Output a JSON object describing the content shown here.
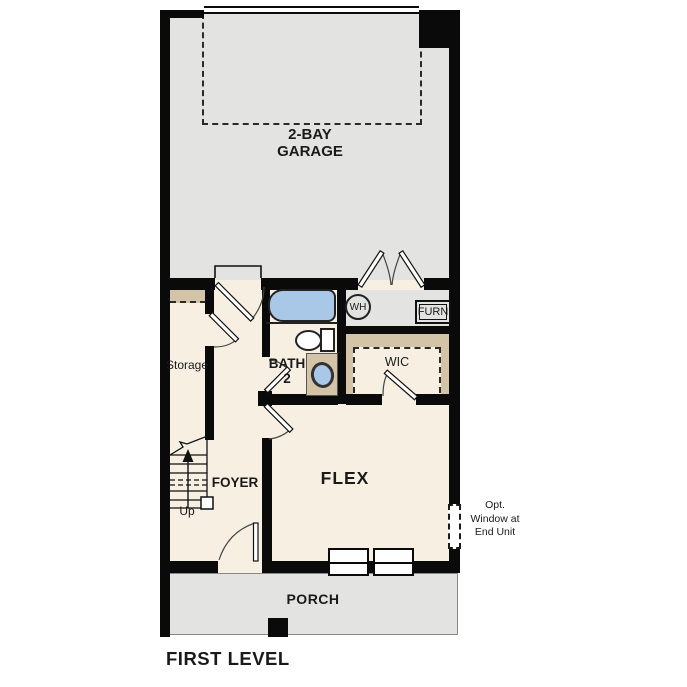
{
  "title": "FIRST LEVEL",
  "colors": {
    "wall": "#0a0a0a",
    "interior_floor": "#f7f0e2",
    "garage_floor": "#e3e3e1",
    "porch_floor": "#e3e3e1",
    "closet_shelf_tan": "#d3c4a7",
    "fixture_blue": "#a9c8e8",
    "window_white": "#ffffff"
  },
  "rooms": {
    "garage": {
      "label_line1": "2-BAY",
      "label_line2": "GARAGE"
    },
    "storage": {
      "label": "Storage"
    },
    "bath2": {
      "label_line1": "BATH",
      "label_line2": "2"
    },
    "foyer": {
      "label": "FOYER"
    },
    "wic": {
      "label": "WIC"
    },
    "flex": {
      "label": "FLEX"
    },
    "porch": {
      "label": "PORCH"
    }
  },
  "fixtures": {
    "water_heater_label": "WH",
    "furnace_label": "FURN"
  },
  "stairs": {
    "label": "Up"
  },
  "notes": {
    "opt_window_line1": "Opt.",
    "opt_window_line2": "Window at",
    "opt_window_line3": "End Unit"
  }
}
